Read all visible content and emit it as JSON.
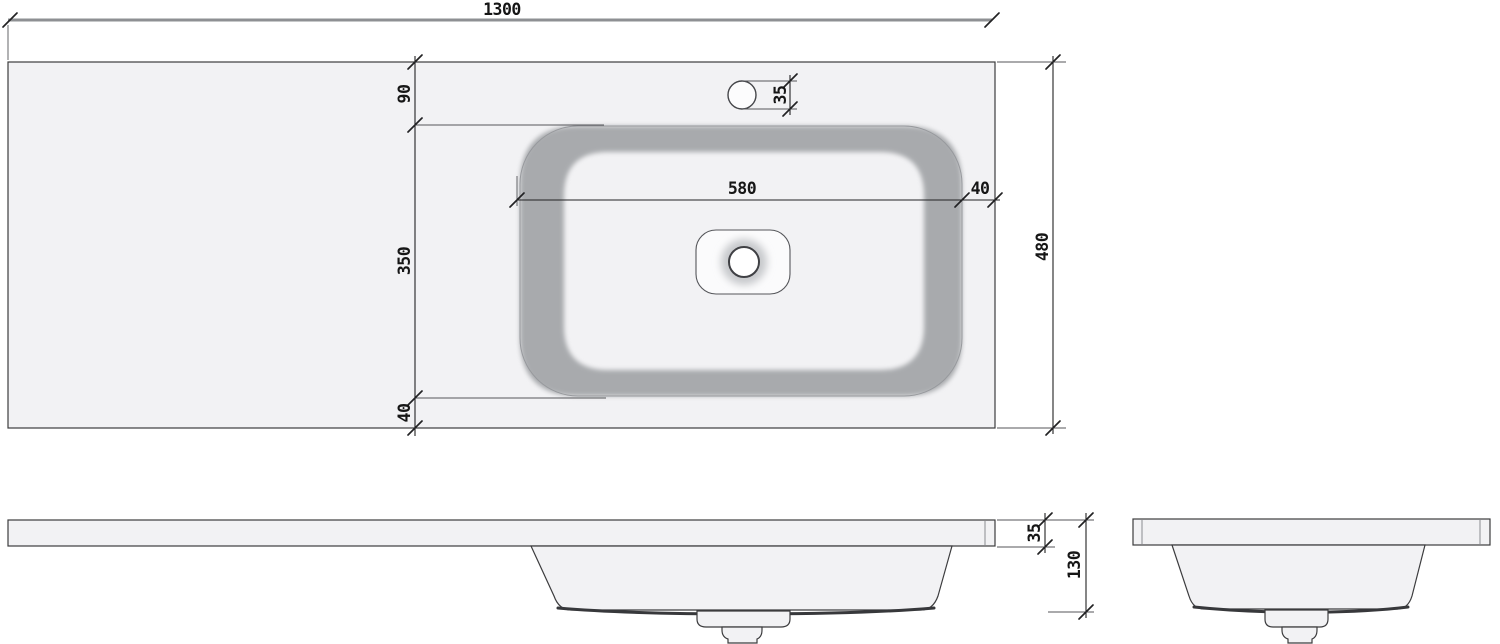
{
  "dimensions": {
    "overall_width": "1300",
    "back_offset": "90",
    "basin_depth": "350",
    "front_offset": "40",
    "overall_depth": "480",
    "basin_width": "580",
    "basin_side_gap": "40",
    "faucet_hole": "35",
    "slab_thickness": "35",
    "overall_height": "130"
  },
  "colors": {
    "background": "#ffffff",
    "surface_fill": "#f2f2f4",
    "basin_wall": "#a8aaad",
    "outline": "#3c3c3e",
    "dim_line": "#222224",
    "overall_dim_line": "#8e9093",
    "text": "#161616"
  }
}
